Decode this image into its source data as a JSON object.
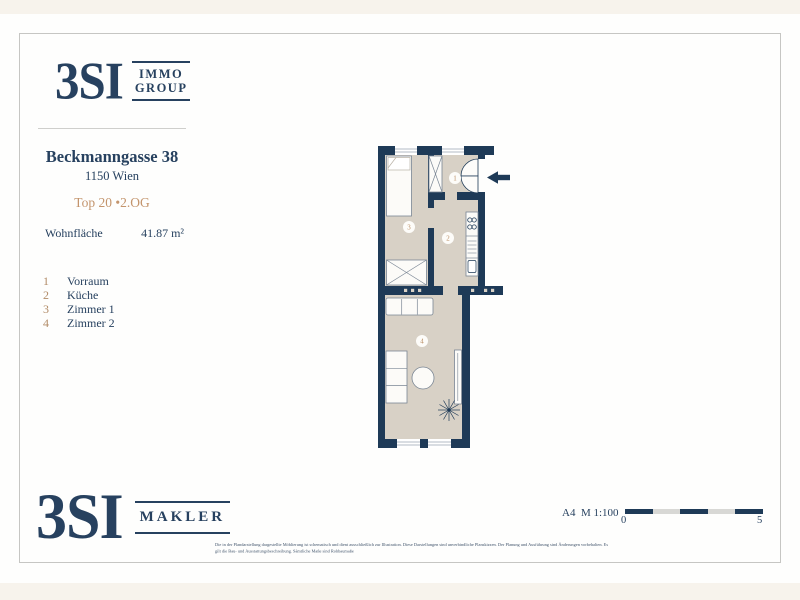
{
  "brand_top": {
    "name": "3SI",
    "box_line1": "IMMO",
    "box_line2": "GROUP"
  },
  "property": {
    "address": "Beckmanngasse 38",
    "city": "1150 Wien",
    "unit": "Top 20 •2.OG",
    "area_label": "Wohnfläche",
    "area_value": "41.87 m²"
  },
  "legend": {
    "items": [
      {
        "number": "1",
        "label": "Vorraum"
      },
      {
        "number": "2",
        "label": "Küche"
      },
      {
        "number": "3",
        "label": "Zimmer 1"
      },
      {
        "number": "4",
        "label": "Zimmer 2"
      }
    ]
  },
  "floorplan": {
    "badges": {
      "vorraum": "1",
      "kueche": "2",
      "zimmer1": "3",
      "zimmer2": "4"
    }
  },
  "brand_bottom": {
    "name": "3SI",
    "box_label": "MAKLER"
  },
  "scale": {
    "format_label": "A4  M 1:100",
    "start": "0",
    "end": "5"
  },
  "disclaimer": {
    "line1": "Die in der Plandarstellung dargestellte Möblierung ist schematisch und dient ausschließlich zur Illustration. Diese Darstellungen sind unverbindliche Planskizzen. Der Planung und Ausführung sind Änderungen vorbehalten. Es",
    "line2": "gilt die Bau- und Ausstattungsbeschreibung. Sämtliche Maße sind Rohbaumaße"
  },
  "colors": {
    "brand_navy": "#27415f",
    "wall_navy": "#1e3a57",
    "accent_tan": "#c3946c",
    "room_fill": "#d8d1c6",
    "page_cream": "#f7f3ec"
  }
}
